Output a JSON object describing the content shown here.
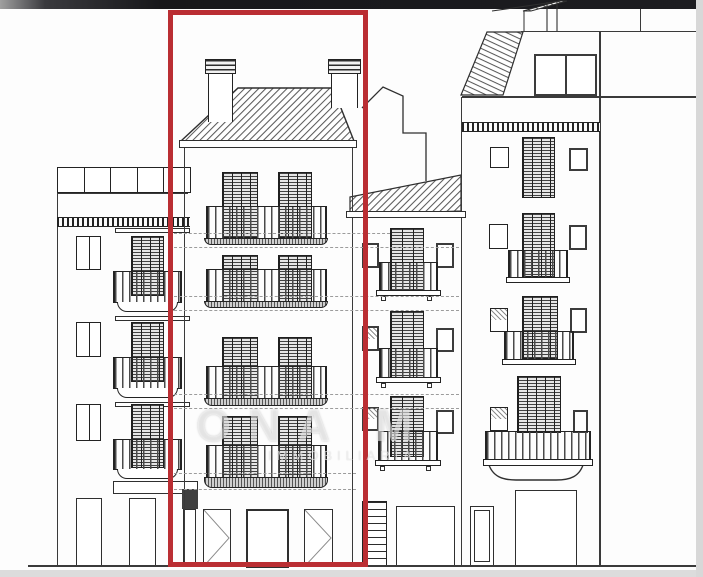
{
  "image": {
    "kind": "architectural street elevation drawing",
    "description": "Line-drawn facade elevation of four adjoining residential buildings; the centre building is outlined with a thick red rectangle (subject property). Faint agency watermark across the middle.",
    "width_px": 703,
    "height_px": 577
  },
  "highlight_box": {
    "marks": "subject building (centre)",
    "color": "#ba2e33",
    "style": "thick rectangular outline, full height of drawing"
  },
  "watermark": {
    "line1": "ONA M",
    "line2": "IMMOBILIARIA"
  },
  "palette": {
    "paper": "#fdfdfd",
    "ink": "#2f2f2f",
    "roof_hatch": "#5a5a5a",
    "dashed_guides": "#9c9c9c",
    "top_bar": "#1d1d21",
    "edge_strips": "#dcdcdc",
    "highlight_red": "#ba2e33"
  },
  "buildings": {
    "left": {
      "position": "far left",
      "roof": "flat roof terrace with 5-panel railing",
      "band": "dentil frieze below terrace",
      "balcony_floors": 3,
      "small_window_per_floor": 1,
      "ground_canopy": "awning band over ground floor",
      "ground_openings": 2
    },
    "subject": {
      "position": "centre, outlined in red",
      "roof": "hipped roof with two chimneys",
      "floors": 4,
      "shuttered_french_doors_per_floor": 2,
      "balcony_railing_per_floor": 1,
      "dashed_level_guides": "at every balcony slab",
      "ground_openings": 3
    },
    "middle": {
      "position": "between subject and right building, lower",
      "roof": "single-pitch hatched roof with stepped party wall above",
      "balcony_floors": 3,
      "flanking_windows_per_floor": 2,
      "ground_floor": "side staircase and shop opening"
    },
    "right": {
      "position": "far right",
      "roof": "set-back attic with pitched hatched roof and wide window",
      "band": "dentil frieze below attic",
      "floors": 4,
      "balconies": 3,
      "bottom_balcony": "wide balcony on curved corbel",
      "ground_openings": 2
    }
  }
}
